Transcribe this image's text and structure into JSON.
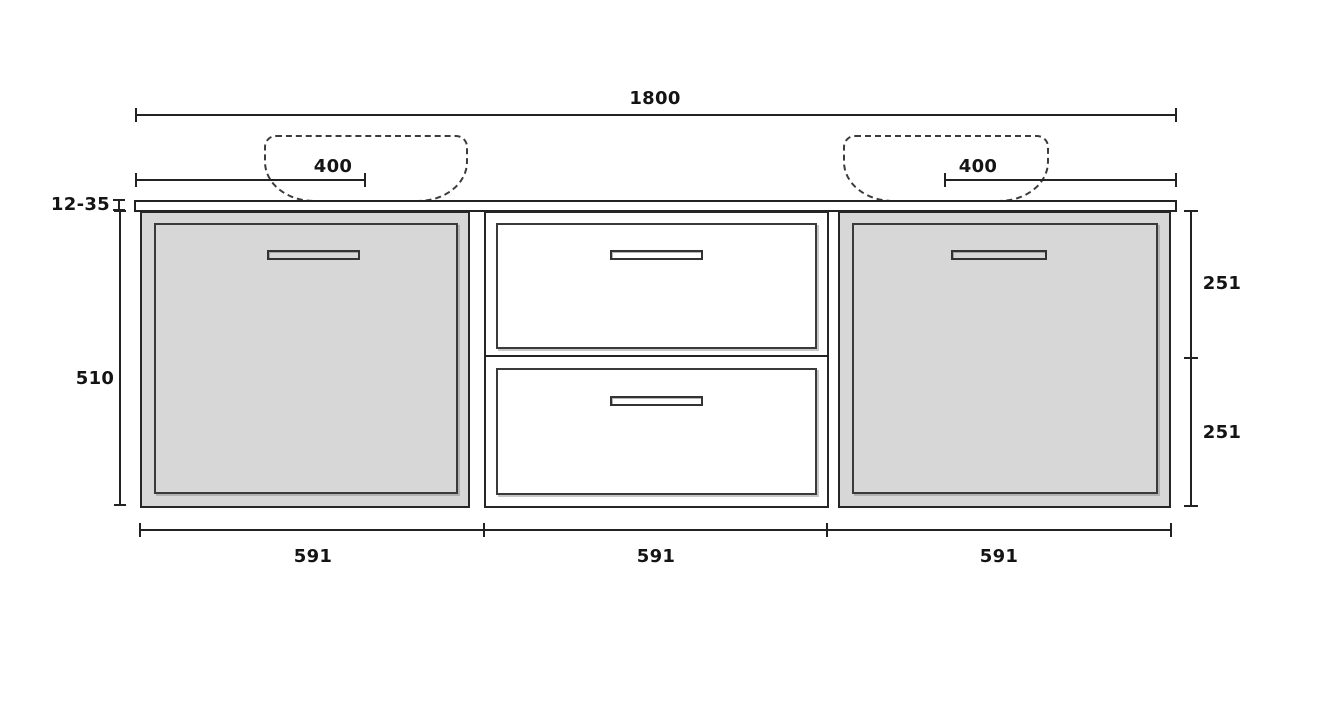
{
  "drawing": {
    "overall_width": "1800",
    "left_sink_offset": "400",
    "right_sink_offset": "400",
    "countertop_thickness": "12-35",
    "cabinet_height": "510",
    "top_drawer_height": "251",
    "bottom_drawer_height": "251",
    "section_widths": [
      "591",
      "591",
      "591"
    ],
    "colors": {
      "line": "#222222",
      "panel_fill": "#d7d7d7",
      "background": "#ffffff"
    }
  }
}
